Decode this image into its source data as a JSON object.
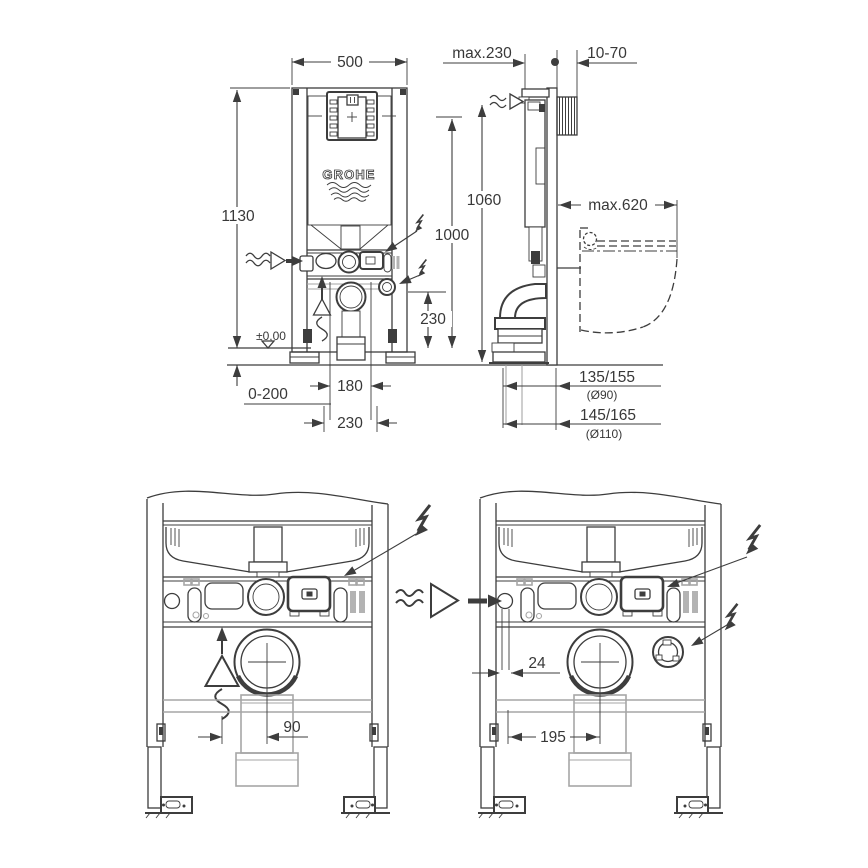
{
  "brand": {
    "name": "GROHE"
  },
  "colors": {
    "line": "#3d3d3d",
    "light_gray": "#a6a6a6",
    "background": "#ffffff"
  },
  "icons": {
    "water_supply": "wavy-arrow",
    "electrical": "lightning-bolt",
    "odour_extraction": "arrow-triangle-wave",
    "floor_datum": "open-triangle"
  },
  "front_view": {
    "width": "500",
    "total_height": "1130",
    "connection_height": "1000",
    "outlet_height": "230",
    "floor_level": "±0,00",
    "floor_buildup": "0-200",
    "drain_spacing": "180",
    "drain_spacing_outer": "230"
  },
  "side_view": {
    "frame_depth": "max.230",
    "wall_range": "10-70",
    "supply_height": "1060",
    "bowl_depth": "max.620",
    "outlet_90": "135/155",
    "outlet_90_dia": "(Ø90)",
    "outlet_110": "145/165",
    "outlet_110_dia": "(Ø110)"
  },
  "detail_left": {
    "vent_offset": "90"
  },
  "detail_right": {
    "inlet_offset": "24",
    "inlet_drain_spacing": "195"
  }
}
